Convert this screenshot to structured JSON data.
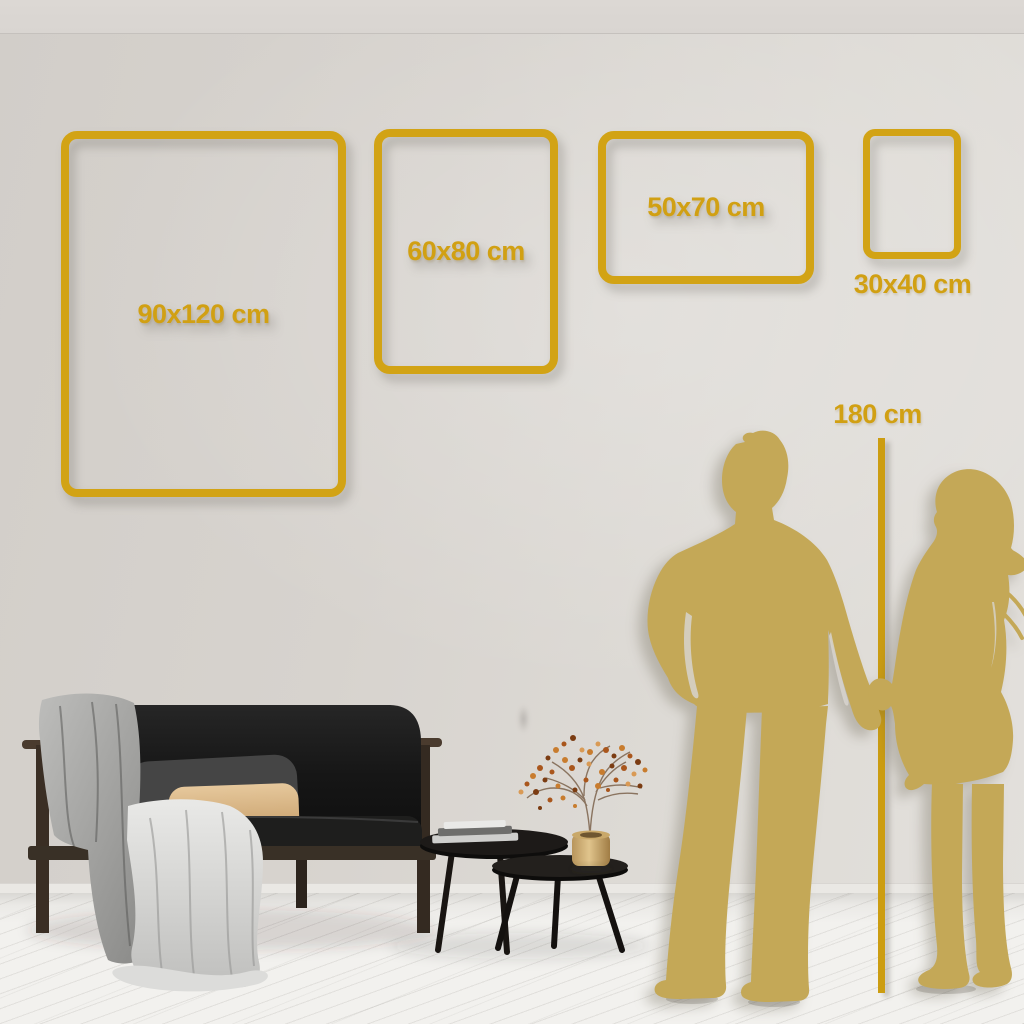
{
  "scene": {
    "frames": [
      {
        "id": "90x120",
        "label": "90x120 cm",
        "width_cm": 90,
        "height_cm": 120,
        "label_position": "inside"
      },
      {
        "id": "60x80",
        "label": "60x80 cm",
        "width_cm": 60,
        "height_cm": 80,
        "label_position": "inside"
      },
      {
        "id": "50x70",
        "label": "50x70 cm",
        "width_cm": 50,
        "height_cm": 70,
        "label_position": "inside"
      },
      {
        "id": "30x40",
        "label": "30x40 cm",
        "width_cm": 30,
        "height_cm": 40,
        "label_position": "below"
      }
    ],
    "height_reference": {
      "label": "180 cm",
      "height_cm": 180
    },
    "colors": {
      "frame_gold": "#d2a315",
      "label_gold": "#d1a013",
      "line_gold": "#cc9d11",
      "silhouette_gold": "#c4a857",
      "wall": "#d7d3ce",
      "floor": "#f2f1ee"
    },
    "scene_objects": [
      "couple-silhouette-holding-hands",
      "dark-velvet-sofa",
      "gray-throw-blanket",
      "beige-pillow",
      "nesting-coffee-tables",
      "book-stack",
      "brass-vase",
      "dried-berry-branch"
    ]
  }
}
